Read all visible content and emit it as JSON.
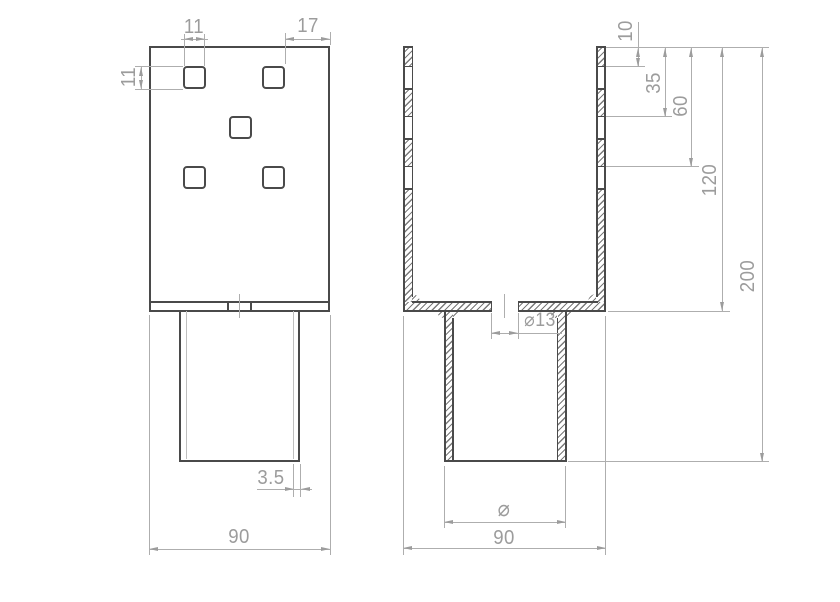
{
  "front_view": {
    "dim_hole_width": "11",
    "dim_hole_height": "11",
    "dim_corner_offset": "17",
    "dim_wall_thickness": "3.5",
    "dim_width": "90"
  },
  "side_view": {
    "dim_hole1_from_top": "10",
    "dim_hole2_from_top": "35",
    "dim_hole3_from_top": "60",
    "dim_channel_depth": "120",
    "dim_overall_height": "200",
    "dim_center_hole": "⌀13",
    "dim_tube_diameter": "⌀",
    "dim_width": "90"
  }
}
